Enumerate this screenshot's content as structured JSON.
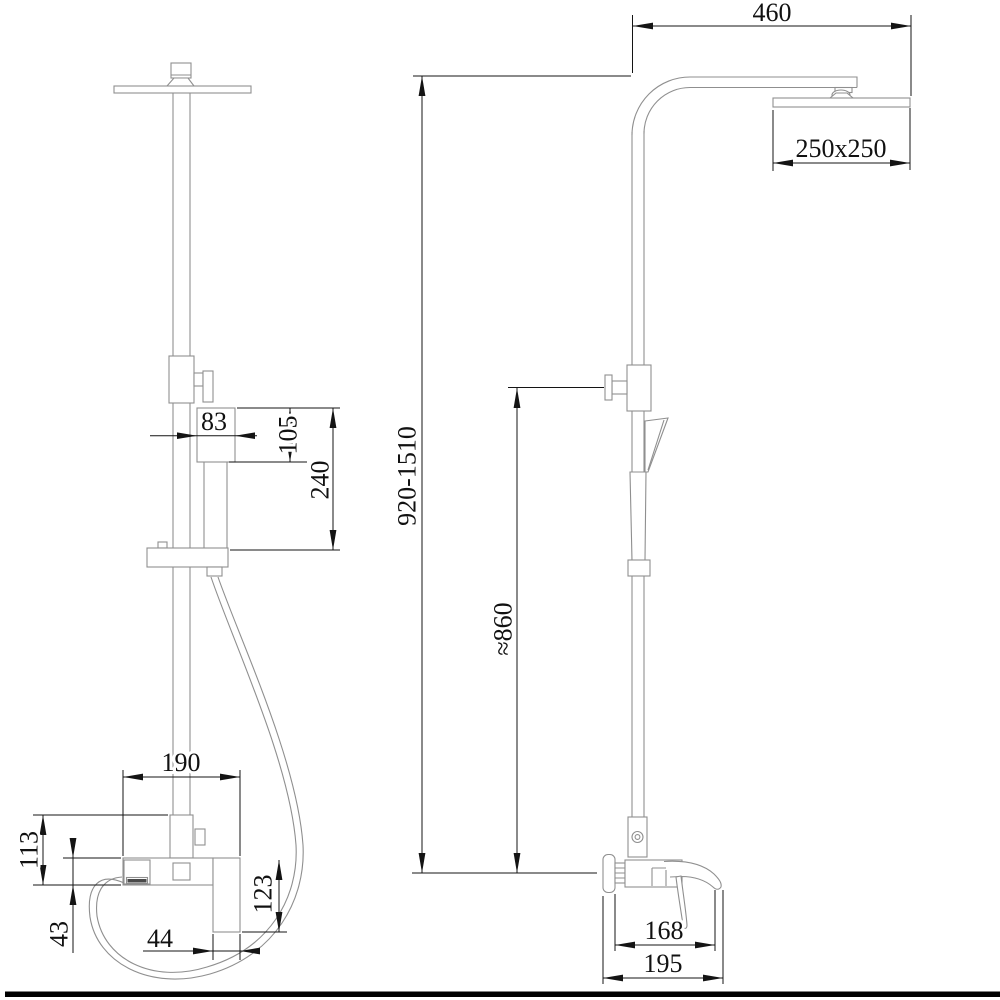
{
  "drawing": {
    "colors": {
      "geometry_line": "#8f8f8f",
      "dimension_line": "#141414",
      "footer_bar": "#000000",
      "background": "#ffffff"
    },
    "dims": {
      "arm_reach": "460",
      "head_size": "250x250",
      "column_height_range": "920-1510",
      "hose_clearance": "≈860",
      "handshower_head_width": "83",
      "handshower_head_height": "105",
      "handshower_length": "240",
      "mixer_width": "190",
      "riser_to_body_height": "113",
      "mixer_body_height": "43",
      "spout_tube_width": "44",
      "spout_drop": "123",
      "spout_reach": "168",
      "mixer_total_depth": "195"
    }
  }
}
